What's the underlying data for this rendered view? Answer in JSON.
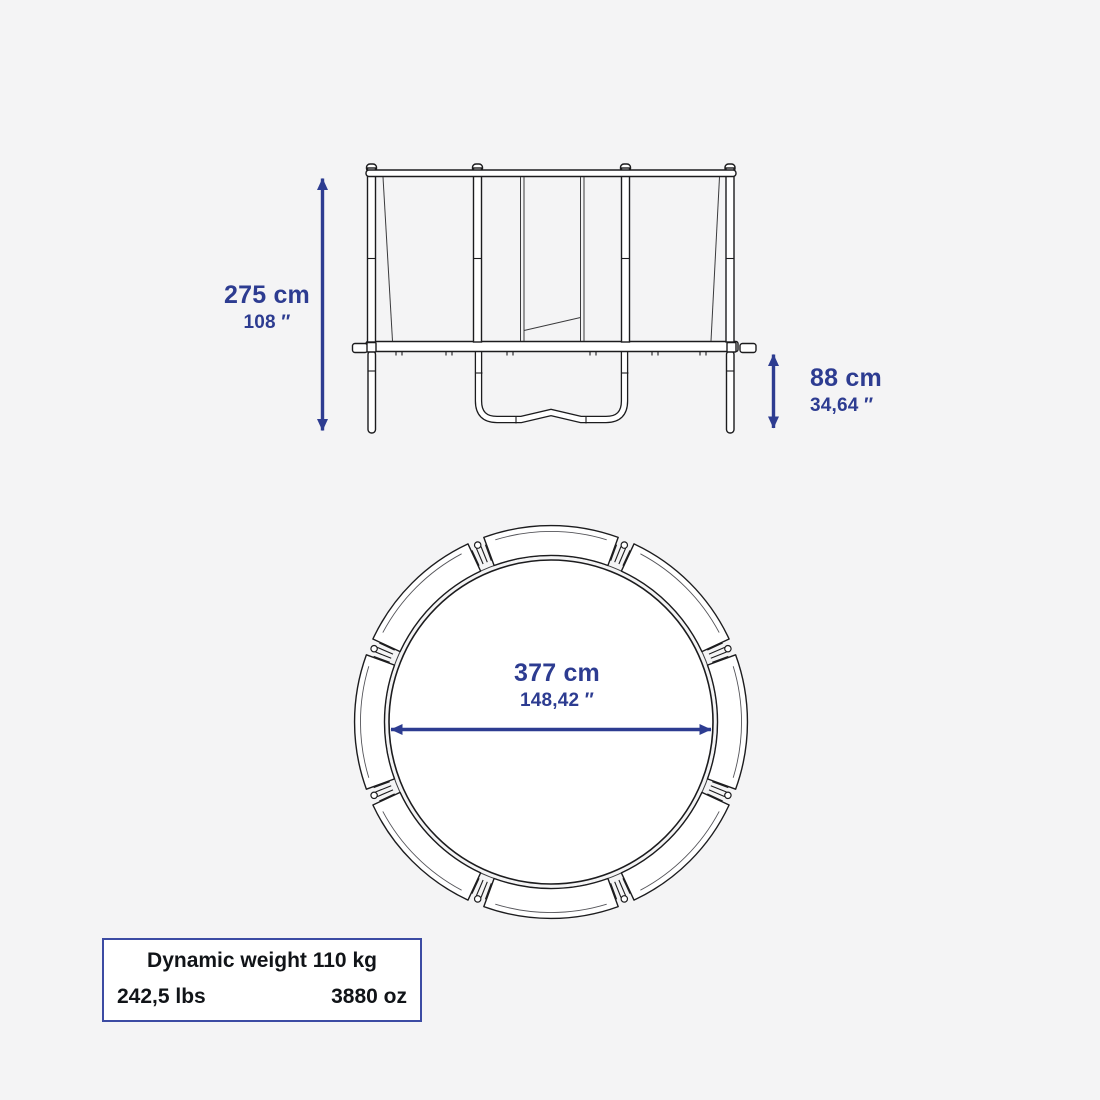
{
  "colors": {
    "background": "#f4f4f5",
    "accent": "#2d3c91",
    "drawing_line": "#1c1c1e",
    "panel_border": "#3c4ba3",
    "panel_bg": "#ffffff",
    "panel_text": "#111418"
  },
  "side_view": {
    "total_height": {
      "primary": "275 cm",
      "secondary": "108 ″"
    },
    "frame_height": {
      "primary": "88 cm",
      "secondary": "34,64 ″"
    }
  },
  "top_view": {
    "diameter": {
      "primary": "377 cm",
      "secondary": "148,42 ″"
    }
  },
  "weight_panel": {
    "title": "Dynamic weight 110 kg",
    "left_value": "242,5 lbs",
    "right_value": "3880 oz"
  }
}
